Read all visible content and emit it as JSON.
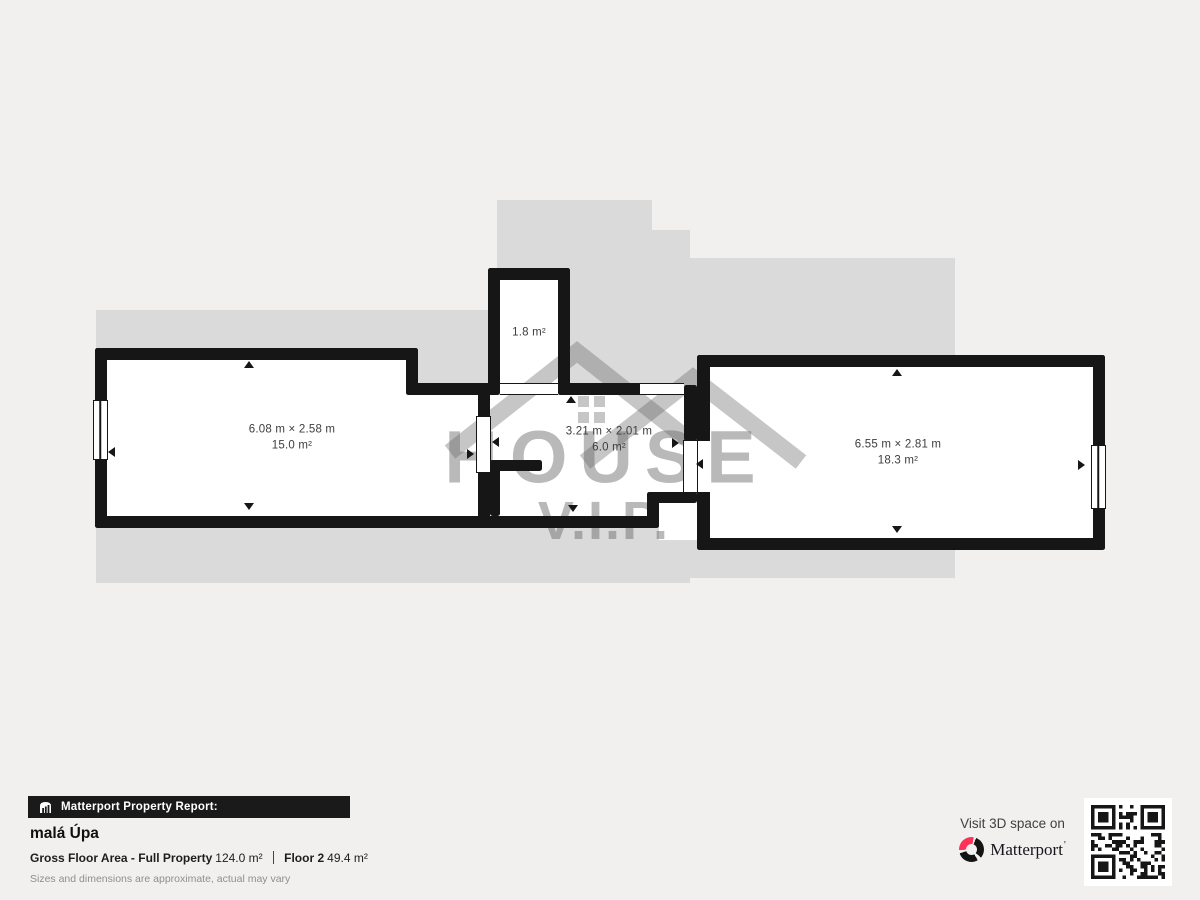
{
  "colors": {
    "background": "#f1f0ee",
    "floor_silhouette": "#dadada",
    "wall": "#161616",
    "brand_pink": "#ff3158",
    "room_label": "#3d3d3d"
  },
  "plan": {
    "rooms": [
      {
        "name": "room-left",
        "dims": "6.08 m × 2.58 m",
        "area": "15.0 m²"
      },
      {
        "name": "room-closet",
        "dims": "",
        "area": "1.8 m²"
      },
      {
        "name": "room-middle",
        "dims": "3.21 m × 2.01 m",
        "area": "6.0 m²"
      },
      {
        "name": "room-right",
        "dims": "6.55 m × 2.81 m",
        "area": "18.3 m²"
      }
    ]
  },
  "watermark": {
    "title": "HOUSE",
    "subtitle": "V.I.P."
  },
  "footer": {
    "report_bar_label": "Matterport Property Report:",
    "property_name": "malá Úpa",
    "gross_floor_area_label": "Gross Floor Area - Full Property",
    "gross_floor_area_value": "124.0 m²",
    "floor_label": "Floor 2",
    "floor_area_value": "49.4 m²",
    "disclaimer": "Sizes and dimensions are approximate, actual may vary"
  },
  "cta": {
    "visit_label": "Visit 3D space on",
    "brand_name": "Matterport",
    "wordmark_tick": "'"
  }
}
